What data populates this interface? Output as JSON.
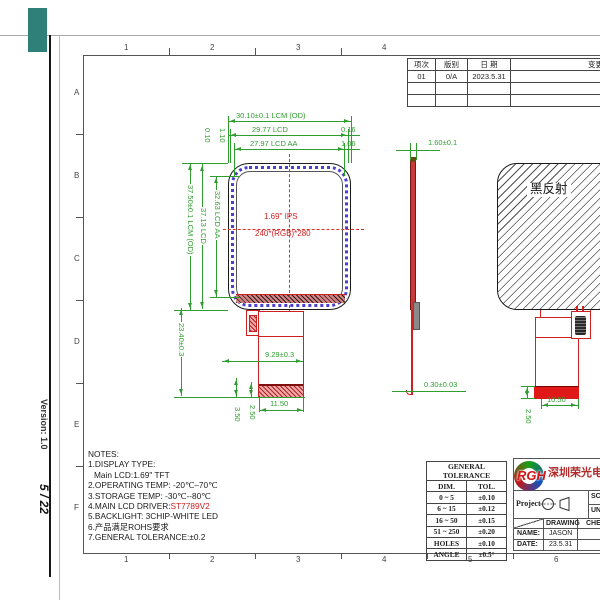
{
  "colors": {
    "dim_green": "#2f9e2f",
    "drawing_red": "#cf2020",
    "panel_band_blue": "#4a3fd0",
    "overlay_teal": "#30807a",
    "logo_red": "#d01818"
  },
  "margin": {
    "version_label": "Version: 1.0",
    "page_indicator": "5 / 22"
  },
  "frame": {
    "cols_top": [
      "1",
      "2",
      "3",
      "4"
    ],
    "cols_bottom": [
      "1",
      "2",
      "3",
      "4",
      "5",
      "6"
    ],
    "rows": [
      "A",
      "B",
      "C",
      "D",
      "E",
      "F"
    ]
  },
  "revision_table": {
    "headers": [
      "项次",
      "版别",
      "日 期",
      "变更"
    ],
    "row1": [
      "01",
      "0/A",
      "2023.5.31",
      ""
    ]
  },
  "front_view": {
    "dim_top_od": "30.10±0.1  LCM  (OD)",
    "dim_top_lcd": "29.77 LCD",
    "dim_top_aa": "27.97  LCD  AA",
    "dim_right_gap1": "0.16",
    "dim_right_gap2": "1.06",
    "dim_left_gap1": "0.10",
    "dim_left_gap2": "1.10",
    "dim_side_od": "37.50±0.1 LCM (OD)",
    "dim_side_lcd": "37.13 LCD",
    "dim_side_aa": "32.63 LCD AA",
    "dim_fpc_height": "23.40±0.3",
    "panel_size_label": "1.69\" IPS",
    "panel_res_label": "240*(RGB)*280",
    "dim_fpc_width_top": "9.29±0.3",
    "dim_fpc_width_bottom": "11.50",
    "dim_fpc_off1": "3.50",
    "dim_fpc_off2": "2.50"
  },
  "side_view": {
    "dim_thickness": "1.60±0.1",
    "dim_fpc_thickness": "0.30±0.03"
  },
  "back_view": {
    "surface_label": "黑反射",
    "dim_stiffener_width": "10.50",
    "dim_stiffener_height": "2.50"
  },
  "notes": {
    "title": "NOTES:",
    "line1": "1.DISPLAY TYPE:",
    "line2": "Main LCD:1.69\" TFT",
    "line3": "2.OPERATING TEMP: -20℃–70℃",
    "line4": "3.STORAGE TEMP: -30℃--80℃",
    "line5_prefix": "4.MAIN LCD DRIVER:",
    "line5_value": "ST7789V2",
    "line6": "5.BACKLIGHT: 3CHIP-WHITE LED",
    "line7": "6.产品满足ROHS要求",
    "line8": "7.GENERAL TOLERANCE:±0.2"
  },
  "tolerance_table": {
    "title": "GENERAL TOLERANCE",
    "header_dim": "DIM.",
    "header_tol": "TOL.",
    "rows": [
      [
        "0 ~ 5",
        "±0.10"
      ],
      [
        "6 ~ 15",
        "±0.12"
      ],
      [
        "16 ~ 50",
        "±0.15"
      ],
      [
        "51 ~ 250",
        "±0.20"
      ],
      [
        "HOLES",
        "±0.10"
      ],
      [
        "ANGLE",
        "±0.5°"
      ]
    ]
  },
  "title_block": {
    "logo_text": "RGH",
    "company_name": "深圳荣光电子",
    "project_label": "Project",
    "scale_label": "SCALE",
    "unit_label": "UNIT",
    "drawing_label": "DRAWING",
    "check_label": "CHECK",
    "name_label": "NAME:",
    "name_value": "JASON",
    "date_label": "DATE:",
    "date_value": "23.5.31"
  }
}
